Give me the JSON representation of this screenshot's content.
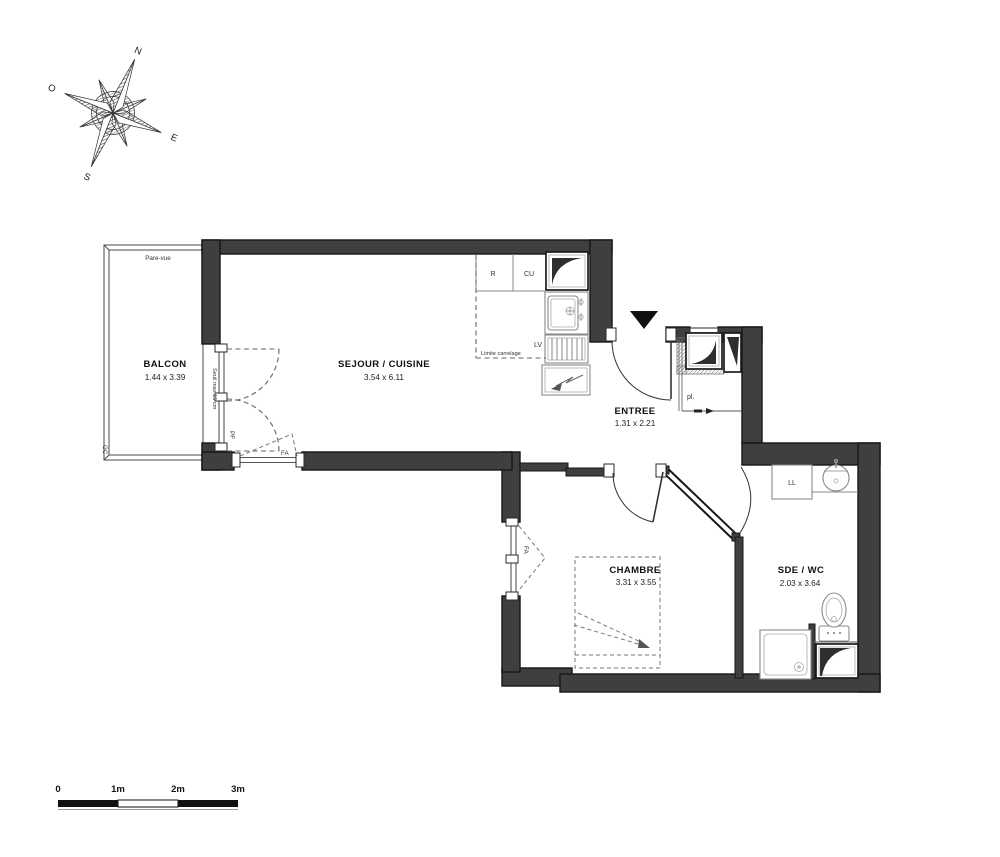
{
  "compass": {
    "north": "N",
    "east": "E",
    "south": "S",
    "west": "O"
  },
  "rooms": {
    "balcon": {
      "name": "BALCON",
      "dims": "1.44 x 3.39"
    },
    "sejour": {
      "name": "SEJOUR / CUISINE",
      "dims": "3.54 x 6.11"
    },
    "entree": {
      "name": "ENTREE",
      "dims": "1.31 x 2.21"
    },
    "chambre": {
      "name": "CHAMBRE",
      "dims": "3.31 x 3.55"
    },
    "sde": {
      "name": "SDE / WC",
      "dims": "2.03 x 3.64"
    }
  },
  "labels": {
    "pare_vue": "Pare-vue",
    "gc": "GC",
    "seuil": "Seuil max 15 cm",
    "pf": "PF",
    "fa": "FA",
    "r": "R",
    "cu": "CU",
    "lv": "LV",
    "limite": "Limite carrelage",
    "pl": "pl.",
    "ll": "LL"
  },
  "scalebar": {
    "t0": "0",
    "t1": "1m",
    "t2": "2m",
    "t3": "3m"
  },
  "colors": {
    "wall": "#3f3f3f",
    "background": "#ffffff",
    "fixture": "#8a8a8a"
  }
}
